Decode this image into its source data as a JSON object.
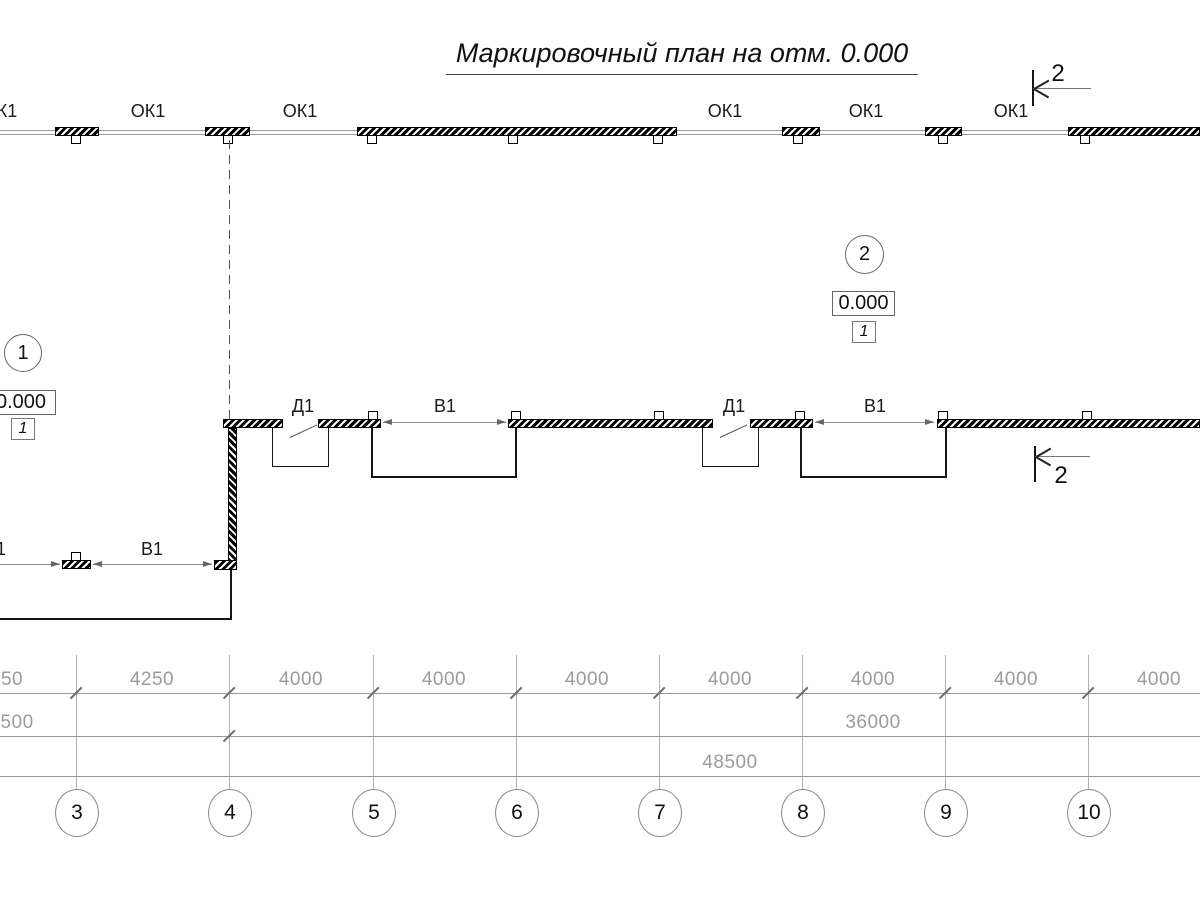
{
  "title": "Маркировочный план на отм. 0.000",
  "section_markers": {
    "top": "2",
    "bottom": "2"
  },
  "node_markers": {
    "left": "1",
    "right": "2"
  },
  "elevations": {
    "left": {
      "value": "0.000",
      "ref": "1"
    },
    "right": {
      "value": "0.000",
      "ref": "1"
    }
  },
  "openings": {
    "windows_top": [
      "ОК1",
      "ОК1",
      "ОК1",
      "ОК1",
      "ОК1",
      "ОК1"
    ],
    "doors": [
      "Д1",
      "Д1"
    ],
    "gates_middle": [
      "В1",
      "В1"
    ],
    "gates_bottom": [
      "В1",
      "В1"
    ]
  },
  "dimensions": {
    "row1": [
      "4250",
      "4250",
      "4000",
      "4000",
      "4000",
      "4000",
      "4000",
      "4000",
      "4000"
    ],
    "row2": [
      "12500",
      "36000"
    ],
    "row3": [
      "48500"
    ]
  },
  "grid_axes": [
    "3",
    "4",
    "5",
    "6",
    "7",
    "8",
    "9",
    "10"
  ]
}
